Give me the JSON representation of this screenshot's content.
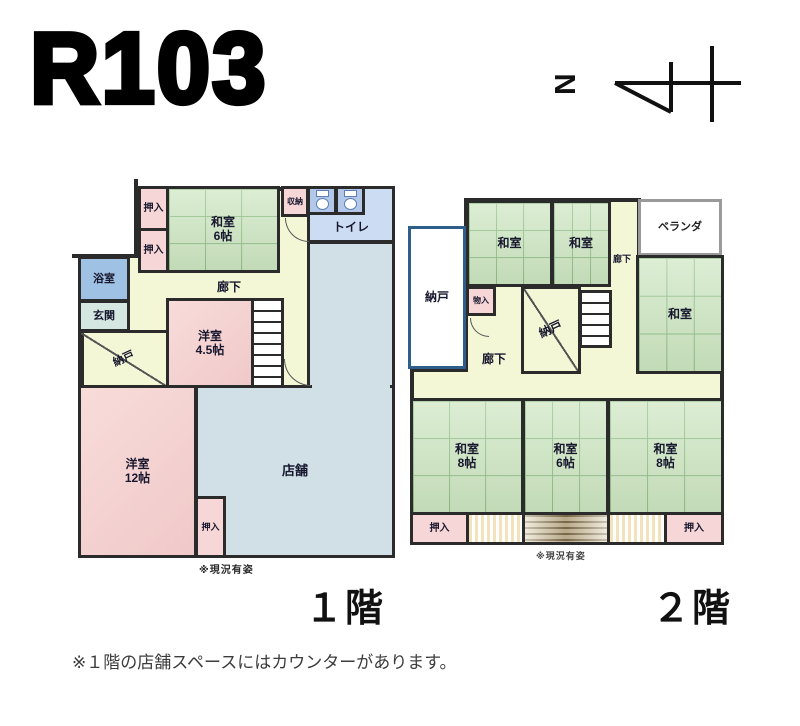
{
  "title": "R103",
  "compass": {
    "direction": "N"
  },
  "floor1": {
    "caption": "１階",
    "condition_note": "※現況有姿",
    "rooms": {
      "oshiire_top": {
        "label": "押入"
      },
      "oshiire_mid": {
        "label": "押入"
      },
      "washitsu6": {
        "label": "和室",
        "size": "6帖"
      },
      "shuno": {
        "label": "収納"
      },
      "toilet": {
        "label": "トイレ"
      },
      "bath": {
        "label": "浴室"
      },
      "genkan": {
        "label": "玄関"
      },
      "nando": {
        "label": "納戸"
      },
      "yoshitsu45": {
        "label": "洋室",
        "size": "4.5帖"
      },
      "hallway": {
        "label": "廊下"
      },
      "shop": {
        "label": "店舗"
      },
      "yoshitsu12": {
        "label": "洋室",
        "size": "12帖"
      },
      "oshiire_bottom": {
        "label": "押入"
      }
    }
  },
  "floor2": {
    "caption": "２階",
    "condition_note": "※現況有姿",
    "rooms": {
      "nando_left": {
        "label": "納戸"
      },
      "washitsu_nw": {
        "label": "和室"
      },
      "washitsu_n": {
        "label": "和室"
      },
      "veranda": {
        "label": "ベランダ"
      },
      "hallway_upper": {
        "label": "廊下"
      },
      "monoire": {
        "label": "物入"
      },
      "nando_center": {
        "label": "納戸"
      },
      "washitsu_e": {
        "label": "和室"
      },
      "hallway_lower": {
        "label": "廊下"
      },
      "washitsu_sw": {
        "label": "和室",
        "size": "8帖"
      },
      "washitsu_s": {
        "label": "和室",
        "size": "6帖"
      },
      "washitsu_se": {
        "label": "和室",
        "size": "8帖"
      },
      "oshiire_sw": {
        "label": "押入"
      },
      "oshiire_se": {
        "label": "押入"
      }
    }
  },
  "footnote": "※１階の店舗スペースにはカウンターがあります。",
  "colors": {
    "wall": "#2b2b2b",
    "tatami_green": "#cde6c1",
    "room_pink": "#f6d6d6",
    "hallway_yellow": "#f4f7d6",
    "bath_blue": "#9fc2e4",
    "toilet_blue": "#ccdcf2",
    "shop_blue": "#d1e0e7",
    "nando_border_blue": "#2e5f8a"
  }
}
